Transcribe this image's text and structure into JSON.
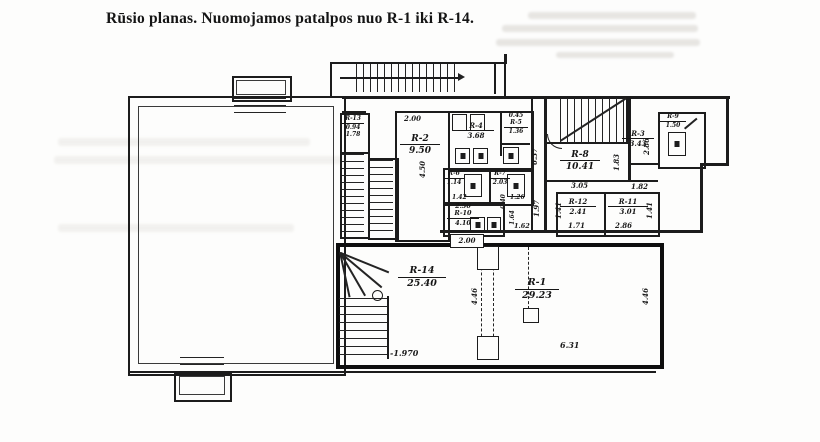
{
  "title": "Rūsio planas. Nuomojamos patalpos nuo R-1 iki R-14.",
  "plan": {
    "rooms": {
      "r1": {
        "number": "R-1",
        "area": "29.23"
      },
      "r2": {
        "number": "R-2",
        "area": "9.50"
      },
      "r3": {
        "number": "R-3",
        "area": "3.43"
      },
      "r4": {
        "number": "R-4",
        "area": "3.68"
      },
      "r5": {
        "number": "R-5",
        "area": "1.36",
        "top": "0.45"
      },
      "r6": {
        "number": "R-6",
        "area": "1.14",
        "width": "1.42"
      },
      "r7": {
        "number": "R-7",
        "area": "2.03",
        "width": "1.26"
      },
      "r8": {
        "number": "R-8",
        "area": "10.41"
      },
      "r9": {
        "number": "R-9",
        "area": "1.50"
      },
      "r10": {
        "number": "R-10",
        "area": "4.10",
        "top": "2.50"
      },
      "r11": {
        "number": "R-11",
        "area": "3.01",
        "bottom": "2.86"
      },
      "r12": {
        "number": "R-12",
        "area": "2.41",
        "bottom": "1.71"
      },
      "r13": {
        "number": "R-13",
        "area": "0.94",
        "extra": "1.78"
      },
      "r14": {
        "number": "R-14",
        "area": "25.40"
      }
    },
    "dims": {
      "r2_width": "2.00",
      "r2_depth": "4.50",
      "corridor_h": "6.37",
      "r3_depth": "2.86",
      "r8_door": "1.83",
      "landing_w": "1.82",
      "r12_top": "3.05",
      "corridor_w": "1.97",
      "r12_left": "1.41",
      "r11_right": "1.41",
      "hall_a": "0.40",
      "hall_b": "1.64",
      "hall_c": "1.62",
      "door_box": "2.00",
      "r14_depth": "4.46",
      "r1_depth": "4.46",
      "r1_width": "6.31",
      "level_mark": "-1.970"
    }
  }
}
